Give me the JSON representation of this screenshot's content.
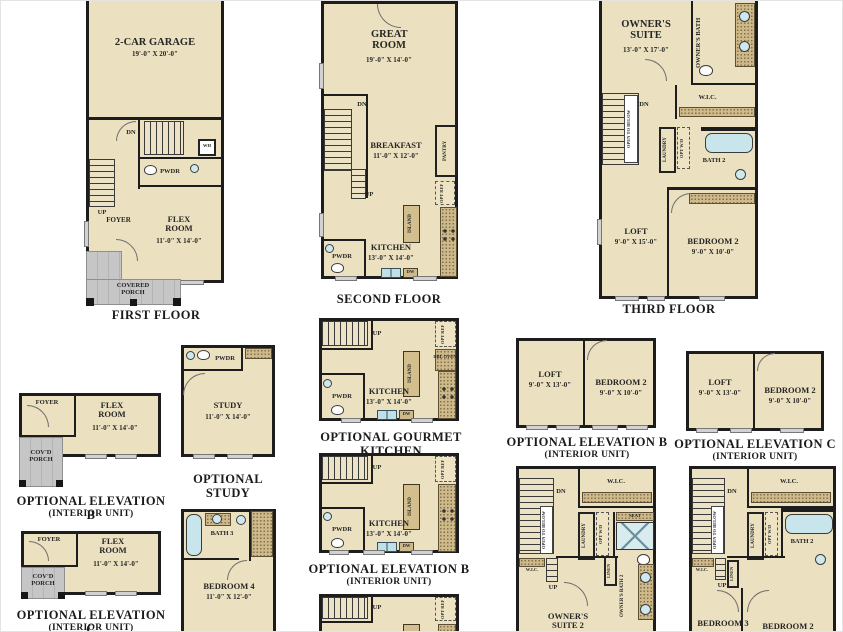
{
  "colors": {
    "floor": "#ebe0bf",
    "wall": "#1d1d1d",
    "porch": "#c6c6c6",
    "counter": "#cdb98a",
    "fixture": "#c7e5eb"
  },
  "plans": {
    "first": {
      "caption": "FIRST FLOOR",
      "garage": "2-CAR GARAGE",
      "garage_dims": "19'-0\" X 20'-0\"",
      "dn": "DN",
      "wh": "WH",
      "pwdr": "PWDR",
      "up": "UP",
      "foyer": "FOYER",
      "flex": "FLEX ROOM",
      "flex_dims": "11'-0\" X 14'-0\"",
      "porch": "COVERED PORCH"
    },
    "second": {
      "caption": "SECOND FLOOR",
      "great": "GREAT ROOM",
      "great_dims": "19'-0\" X 14'-0\"",
      "dn": "DN",
      "up": "UP",
      "breakfast": "BREAKFAST",
      "breakfast_dims": "11'-0\" X 12'-0\"",
      "pantry": "PANTRY",
      "opt_ref": "OPT REF",
      "island": "ISLAND",
      "kitchen": "KITCHEN",
      "kitchen_dims": "13'-0\" X 14'-0\"",
      "pwdr": "PWDR",
      "dw": "DW"
    },
    "third": {
      "caption": "THIRD FLOOR",
      "suite": "OWNER'S SUITE",
      "suite_dims": "13'-0\" X 17'-0\"",
      "bath": "OWNER'S BATH",
      "wic": "W.I.C.",
      "dn": "DN",
      "open_below": "OPEN TO BELOW",
      "laundry": "LAUNDRY",
      "opt_wd": "OPT W/D",
      "bath2": "BATH 2",
      "loft": "LOFT",
      "loft_dims": "9'-0\" X 15'-0\"",
      "bed2": "BEDROOM 2",
      "bed2_dims": "9'-0\" X 10'-0\""
    },
    "optB_flex": {
      "caption": "OPTIONAL ELEVATION B",
      "caption2": "(INTERIOR UNIT)",
      "foyer": "FOYER",
      "flex": "FLEX ROOM",
      "flex_dims": "11'-0\" X 14'-0\"",
      "porch": "COV'D PORCH"
    },
    "study": {
      "caption": "OPTIONAL STUDY",
      "pwdr": "PWDR",
      "study": "STUDY",
      "study_dims": "11'-0\" X 14'-0\""
    },
    "gourmet": {
      "caption": "OPTIONAL GOURMET KITCHEN",
      "up": "UP",
      "opt_ref": "OPT REF",
      "dbl_oven": "DBL OVEN",
      "island": "ISLAND",
      "kitchen": "KITCHEN",
      "kitchen_dims": "13'-0\" X 14'-0\"",
      "pwdr": "PWDR",
      "dw": "DW"
    },
    "optB_kitchen": {
      "caption": "OPTIONAL ELEVATION B",
      "caption2": "(INTERIOR UNIT)",
      "up": "UP",
      "opt_ref": "OPT REF",
      "island": "ISLAND",
      "kitchen": "KITCHEN",
      "kitchen_dims": "13'-0\" X 14'-0\"",
      "pwdr": "PWDR",
      "dw": "DW"
    },
    "optC_kitchen": {
      "up": "UP",
      "opt_ref": "OPT REF",
      "island": "ISLAND"
    },
    "optB_loft": {
      "caption": "OPTIONAL ELEVATION B",
      "caption2": "(INTERIOR UNIT)",
      "loft": "LOFT",
      "loft_dims": "9'-0\" X 13'-0\"",
      "bed2": "BEDROOM 2",
      "bed2_dims": "9'-0\" X 10'-0\""
    },
    "optC_loft": {
      "caption": "OPTIONAL ELEVATION C",
      "caption2": "(INTERIOR UNIT)",
      "loft": "LOFT",
      "loft_dims": "9'-0\" X 13'-0\"",
      "bed2": "BEDROOM 2",
      "bed2_dims": "9'-0\" X 10'-0\""
    },
    "optC_flex": {
      "caption": "OPTIONAL ELEVATION C",
      "caption2": "(INTERIOR UNIT)",
      "foyer": "FOYER",
      "flex": "FLEX ROOM",
      "flex_dims": "11'-0\" X 14'-0\"",
      "porch": "COV'D PORCH"
    },
    "bed4": {
      "bath3": "BATH 3",
      "bed4": "BEDROOM 4",
      "bed4_dims": "11'-0\" X 12'-0\""
    },
    "suite2": {
      "dn": "DN",
      "wic": "W.I.C.",
      "open_below": "OPEN TO BELOW",
      "laundry": "LAUNDRY",
      "opt_wd": "OPT W/D",
      "seat": "SEAT",
      "wic2": "W.I.C.",
      "up": "UP",
      "linen": "LINEN",
      "bath2": "OWNER'S BATH 2",
      "suite2": "OWNER'S SUITE 2"
    },
    "bed3": {
      "dn": "DN",
      "wic": "W.I.C.",
      "open_below": "OPEN TO BELOW",
      "laundry": "LAUNDRY",
      "opt_wd": "OPT W/D",
      "bath2": "BATH 2",
      "wic2": "W.I.C.",
      "up": "UP",
      "linen": "LINEN",
      "bed3": "BEDROOM 3",
      "bed2": "BEDROOM 2"
    }
  }
}
